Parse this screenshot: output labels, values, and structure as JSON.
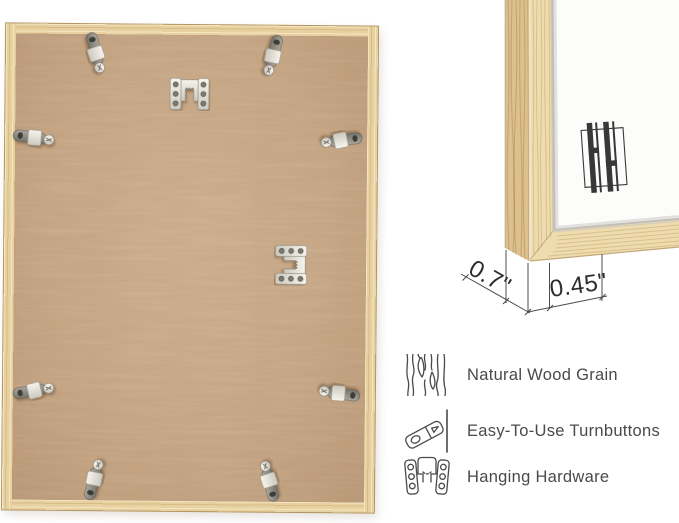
{
  "colors": {
    "frame_wood": "#e8d1a0",
    "wood_grain": "#c9a76b",
    "mdf_backing": "#c9a887",
    "hardware_metal": "#e9e7df",
    "mat": "#fcfcfb",
    "annotation_ink": "#2d2d2d",
    "feature_text": "#4a4a4a"
  },
  "back_view": {
    "turnbutton_count": 8,
    "hanger_count": 2
  },
  "corner_detail": {
    "depth_label": "0.7\"",
    "width_label": "0.45\"",
    "logo": "hh-monogram"
  },
  "features": {
    "items": [
      {
        "icon": "wood-grain-icon",
        "label": "Natural Wood Grain"
      },
      {
        "icon": "turnbutton-icon",
        "label": "Easy-To-Use Turnbuttons"
      },
      {
        "icon": "hanging-hardware-icon",
        "label": "Hanging Hardware"
      }
    ]
  }
}
